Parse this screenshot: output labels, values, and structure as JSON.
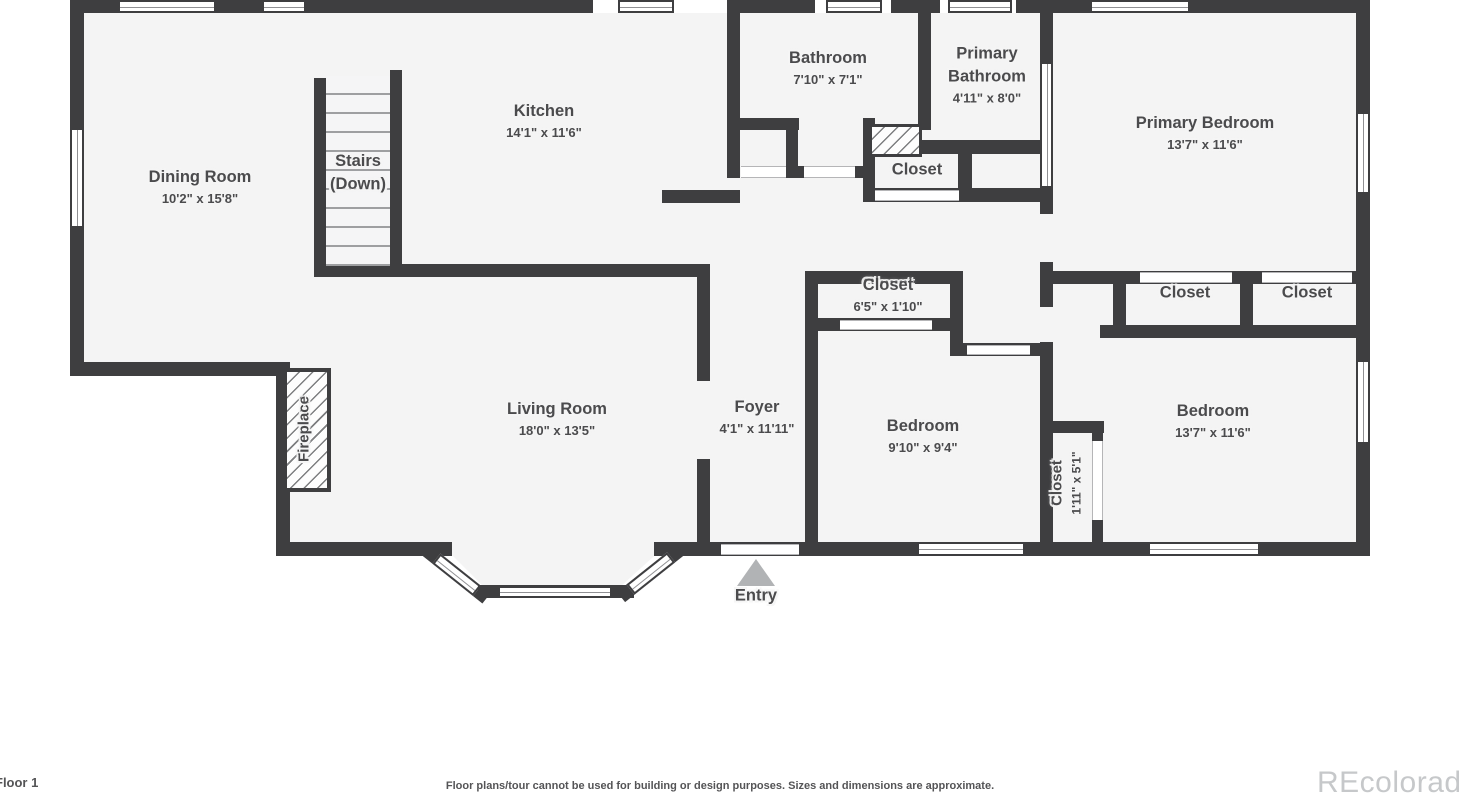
{
  "plan": {
    "rooms": {
      "dining": {
        "name": "Dining Room",
        "dims": "10'2\" x 15'8\""
      },
      "kitchen": {
        "name": "Kitchen",
        "dims": "14'1\" x 11'6\""
      },
      "stairs": {
        "name": "Stairs (Down)"
      },
      "bathroom": {
        "name": "Bathroom",
        "dims": "7'10\" x 7'1\""
      },
      "primary_bathroom": {
        "name": "Primary Bathroom",
        "dims": "4'11\" x 8'0\""
      },
      "primary_bedroom": {
        "name": "Primary Bedroom",
        "dims": "13'7\" x 11'6\""
      },
      "hall_closet": {
        "name": "Closet"
      },
      "mid_closet": {
        "name": "Closet",
        "dims": "6'5\" x 1'10\""
      },
      "primary_closet_left": {
        "name": "Closet"
      },
      "primary_closet_right": {
        "name": "Closet"
      },
      "living": {
        "name": "Living Room",
        "dims": "18'0\" x 13'5\""
      },
      "foyer": {
        "name": "Foyer",
        "dims": "4'1\" x 11'11\""
      },
      "bedroom_mid": {
        "name": "Bedroom",
        "dims": "9'10\" x 9'4\""
      },
      "bedroom_right": {
        "name": "Bedroom",
        "dims": "13'7\" x 11'6\""
      },
      "small_closet": {
        "name": "Closet",
        "dims": "1'11\" x 5'1\""
      },
      "fireplace": {
        "name": "Fireplace"
      },
      "entry": {
        "name": "Entry"
      }
    }
  },
  "footer": {
    "floor_label": "Floor 1",
    "disclaimer": "Floor plans/tour cannot be used for building or design purposes. Sizes and dimensions are approximate.",
    "watermark": "REcolorado"
  },
  "colors": {
    "wall": "#3e3e40",
    "floor": "#f4f4f4",
    "label_text": "#4b4b4d",
    "entry_arrow": "#b1b3b5",
    "watermark": "#c6c8ca"
  }
}
